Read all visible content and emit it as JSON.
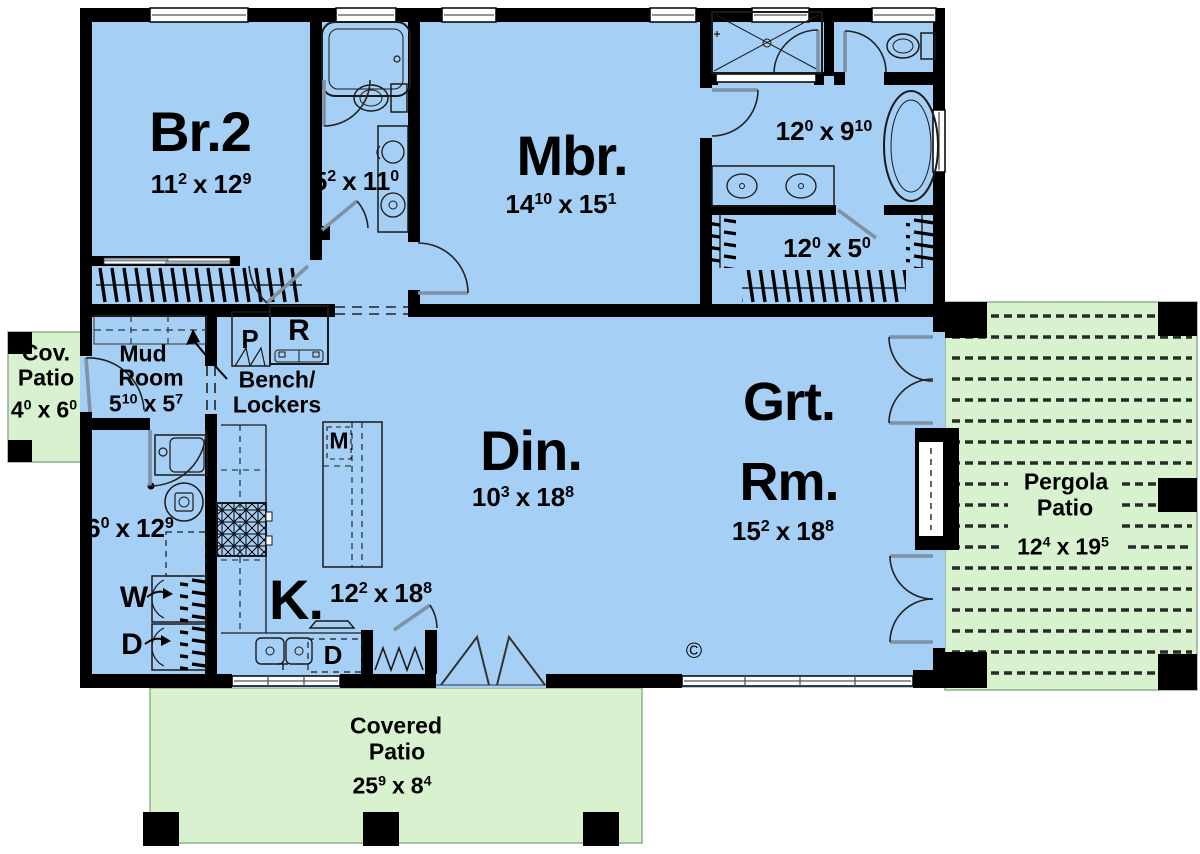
{
  "plan": {
    "colors": {
      "floor_blue": "#a6cff5",
      "patio_green": "#d8f2cf",
      "wall_black": "#000000"
    },
    "separator": "x",
    "copyright_mark": "©",
    "rooms": {
      "bedroom2": {
        "name": "Br.2",
        "w": "11",
        "wi": "2",
        "l": "12",
        "li": "9"
      },
      "hall_bath": {
        "w": "5",
        "wi": "2",
        "l": "11",
        "li": "0"
      },
      "master_bedroom": {
        "name": "Mbr.",
        "w": "14",
        "wi": "10",
        "l": "15",
        "li": "1"
      },
      "master_bath": {
        "w": "12",
        "wi": "0",
        "l": "9",
        "li": "10"
      },
      "master_closet": {
        "w": "12",
        "wi": "0",
        "l": "5",
        "li": "0"
      },
      "cov_patio": {
        "name1": "Cov.",
        "name2": "Patio",
        "w": "4",
        "wi": "0",
        "l": "6",
        "li": "0"
      },
      "mud_room": {
        "name1": "Mud",
        "name2": "Room",
        "w": "5",
        "wi": "10",
        "l": "5",
        "li": "7"
      },
      "bench_lockers": {
        "name1": "Bench/",
        "name2": "Lockers"
      },
      "laundry": {
        "w": "6",
        "wi": "0",
        "l": "12",
        "li": "9"
      },
      "kitchen": {
        "name": "K.",
        "w": "12",
        "wi": "2",
        "l": "18",
        "li": "8"
      },
      "dining": {
        "name": "Din.",
        "w": "10",
        "wi": "3",
        "l": "18",
        "li": "8"
      },
      "great_room": {
        "name1": "Grt.",
        "name2": "Rm.",
        "w": "15",
        "wi": "2",
        "l": "18",
        "li": "8"
      },
      "pergola_patio": {
        "name1": "Pergola",
        "name2": "Patio",
        "w": "12",
        "wi": "4",
        "l": "19",
        "li": "5"
      },
      "covered_patio": {
        "name1": "Covered",
        "name2": "Patio",
        "w": "25",
        "wi": "9",
        "l": "8",
        "li": "4"
      }
    },
    "fixtures": {
      "pantry": "P",
      "fridge": "R",
      "island": "M",
      "washer": "W",
      "dryer": "D",
      "dishwasher": "D"
    }
  }
}
